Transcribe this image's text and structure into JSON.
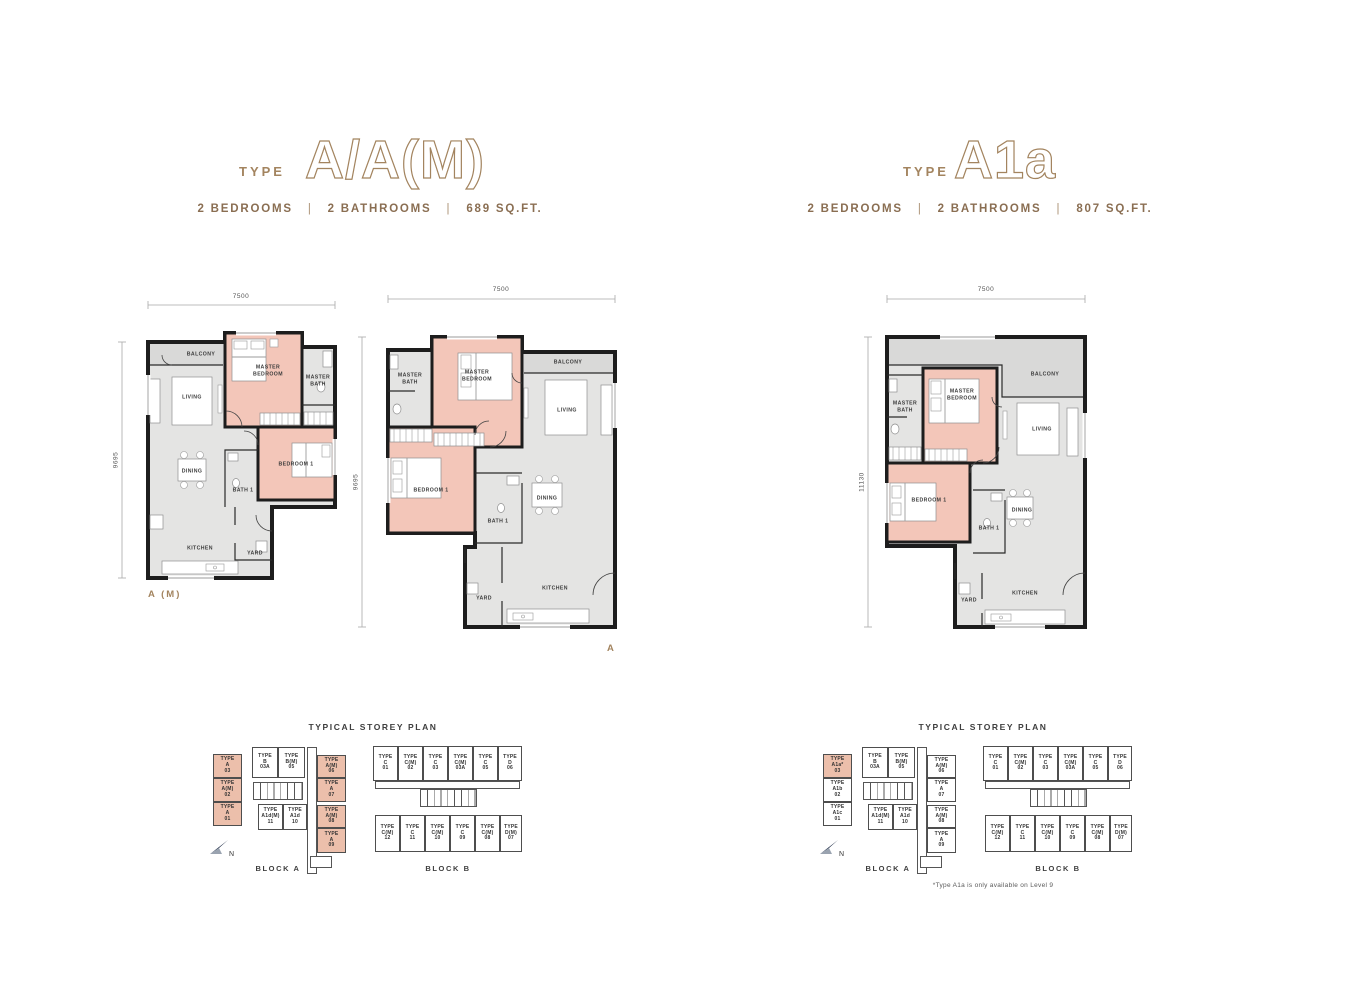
{
  "colors": {
    "accent_tan": "#a3845f",
    "bedroom_highlight": "#f3c6b9",
    "floor_gray": "#e4e4e3",
    "balcony_gray": "#d9d9d8",
    "wall_black": "#1d1d1d",
    "storey_unit_highlight": "#ecbfab"
  },
  "left_page": {
    "type_label": "TYPE",
    "type_name": "A/A(M)",
    "bedrooms": "2 BEDROOMS",
    "bathrooms": "2 BATHROOMS",
    "area": "689 SQ.FT.",
    "separator": "|",
    "plan_am": {
      "label": "A (M)",
      "width_dim": "7500",
      "height_dim": "9695"
    },
    "plan_a": {
      "label": "A",
      "width_dim": "7500",
      "height_dim": "9695"
    }
  },
  "right_page": {
    "type_label": "TYPE",
    "type_name": "A1a",
    "bedrooms": "2 BEDROOMS",
    "bathrooms": "2 BATHROOMS",
    "area": "807 SQ.FT.",
    "separator": "|",
    "plan_a1a": {
      "width_dim": "7500",
      "height_dim": "11130"
    },
    "footnote": "*Type A1a is only available on Level 9"
  },
  "rooms": {
    "balcony": "BALCONY",
    "living": "LIVING",
    "master_bedroom": "MASTER\nBEDROOM",
    "master_bath": "MASTER\nBATH",
    "dining": "DINING",
    "bath1": "BATH 1",
    "bedroom1": "BEDROOM 1",
    "kitchen": "KITCHEN",
    "yard": "YARD"
  },
  "storey_plan": {
    "title": "TYPICAL STOREY PLAN",
    "block_a": "BLOCK A",
    "block_b": "BLOCK B",
    "north": "N",
    "typical": {
      "block_a_units": {
        "left_col": [
          "TYPE\nA\n03",
          "TYPE\nA(M)\n02",
          "TYPE\nA\n01"
        ],
        "top_mid": [
          "TYPE\nB\n03A",
          "TYPE\nB(M)\n05"
        ],
        "bottom_mid": [
          "TYPE\nA1d(M)\n11",
          "TYPE\nA1d\n10"
        ],
        "right_col": [
          "TYPE\nA(M)\n06",
          "TYPE\nA\n07",
          "TYPE\nA(M)\n08",
          "TYPE\nA\n09"
        ]
      }
    },
    "level9": {
      "block_a_units": {
        "left_col": [
          "TYPE\nA1a*\n03",
          "TYPE\nA1b\n02",
          "TYPE\nA1c\n01"
        ],
        "top_mid": [
          "TYPE\nB\n03A",
          "TYPE\nB(M)\n05"
        ],
        "bottom_mid": [
          "TYPE\nA1d(M)\n11",
          "TYPE\nA1d\n10"
        ],
        "right_col": [
          "TYPE\nA(M)\n06",
          "TYPE\nA\n07",
          "TYPE\nA(M)\n08",
          "TYPE\nA\n09"
        ]
      }
    },
    "block_b_units": {
      "top_row": [
        "TYPE\nC\n01",
        "TYPE\nC(M)\n02",
        "TYPE\nC\n03",
        "TYPE\nC(M)\n03A",
        "TYPE\nC\n05",
        "TYPE\nD\n06"
      ],
      "bottom_row": [
        "TYPE\nC(M)\n12",
        "TYPE\nC\n11",
        "TYPE\nC(M)\n10",
        "TYPE\nC\n09",
        "TYPE\nC(M)\n08",
        "TYPE\nD(M)\n07"
      ]
    }
  }
}
